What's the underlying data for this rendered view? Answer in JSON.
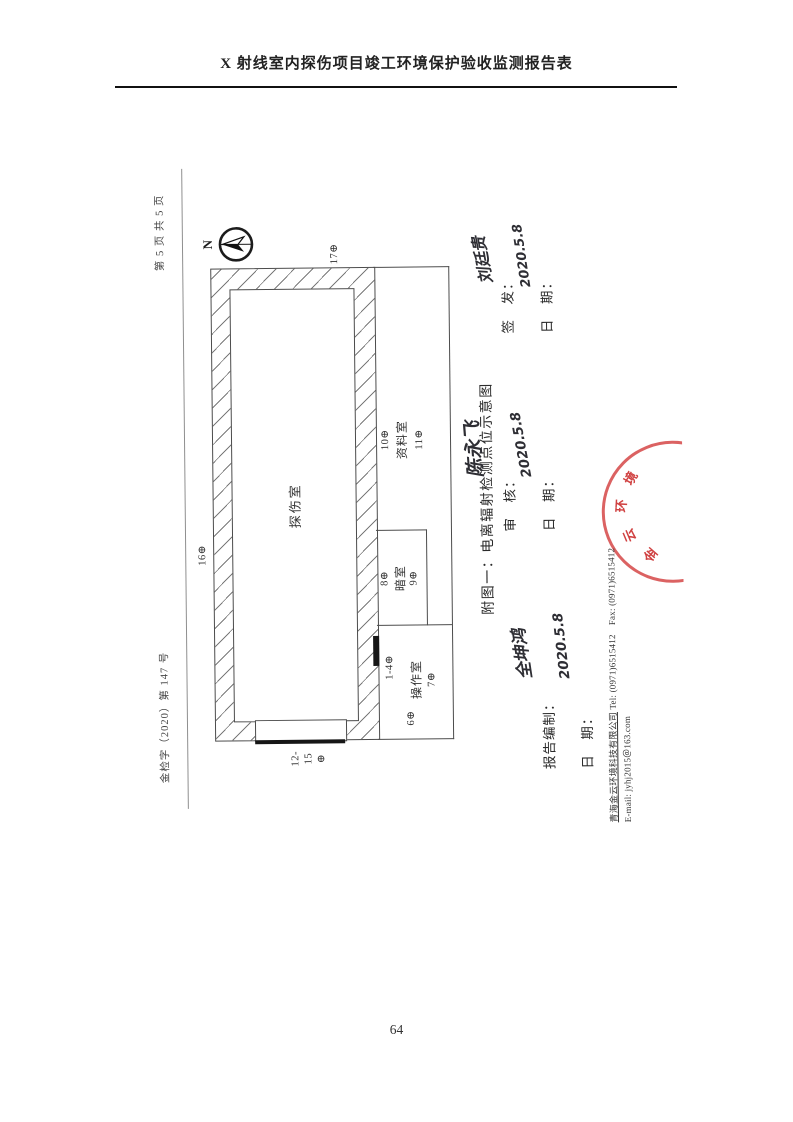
{
  "page": {
    "title": "X 射线室内探伤项目竣工环境保护验收监测报告表",
    "page_number": "64"
  },
  "scan": {
    "doc_number": "金检字（2020）第 147 号",
    "page_marker": "第 5 页 共 5 页",
    "compass": {
      "label": "N"
    },
    "caption": "附图一：电离辐射检测点位示意图",
    "plan": {
      "rooms": {
        "exposure": "探伤室",
        "archive": "资料室",
        "dark": "暗室",
        "control": "操作室"
      },
      "points": {
        "p16": "16⊕",
        "p17": "17⊕",
        "p12_15": [
          "12-",
          "15",
          "⊕"
        ],
        "p1_4": "1-4⊕",
        "p6": "6⊕",
        "p7": "7⊕",
        "p8": "8⊕",
        "p9": "9⊕",
        "p10": "10⊕",
        "p11": "11⊕"
      }
    },
    "signatures": {
      "prepared": {
        "label": "报告编制：",
        "name": "全坤鸿",
        "date_label": "日　期：",
        "date": "2020.5.8"
      },
      "reviewed": {
        "label": "审　核：",
        "name": "陈永飞",
        "date_label": "日　期：",
        "date": "2020.5.8"
      },
      "issued": {
        "label": "签　发：",
        "name": "刘廷贵",
        "date_label": "日　期：",
        "date": "2020.5.8"
      }
    },
    "stamp": {
      "chars": [
        "金",
        "云",
        "环",
        "境"
      ],
      "color": "#cf2e2e"
    },
    "footer": {
      "company": "青海金云环境科技有限公司",
      "tel_fax": "Tel: (0971)6515412　Fax: (0971)6515412",
      "email": "E-mail: jyhj2015＠163.com"
    }
  }
}
